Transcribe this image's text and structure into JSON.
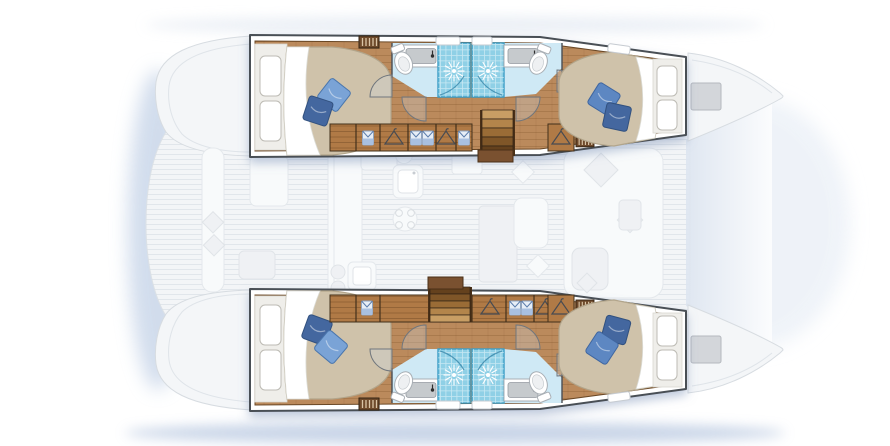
{
  "vessel": {
    "type": "catamaran yacht floor plan",
    "view": "top-down deck / cabin layout illustration",
    "hulls": 2,
    "orientation": "bows pointing right, sterns left",
    "cabins": 4,
    "bathrooms": 4
  },
  "inventory": {
    "double_beds": 4,
    "pillows_per_bed": 2,
    "showers": 4,
    "toilets": 4,
    "sinks": 4,
    "staircases": 2,
    "hanging_lockers": "wardrobes with hanger and folded-shirt symbols in each hull",
    "bow_deck_hatches": 2,
    "ghosted_areas": "aft cockpit with bench and table, central salon with galley sink, stove, dining table, chairs and forward lounge"
  },
  "colors": {
    "hull_outline": "#4a4f55",
    "wood": "#bb8a5c",
    "wood_dark": "#7c5330",
    "locker": "#b07a46",
    "bed": "#cfc2aa",
    "bed_edge": "#b2a58b",
    "pillow_light": "#7aa3d6",
    "pillow_mid": "#5d87c2",
    "pillow_dark": "#44679f",
    "bath_floor": "#cfe9f5",
    "shower": "#8fd0e6",
    "shower_edge": "#3c9ec6",
    "basin": "#c6cacd",
    "hatch": "#d3d6da",
    "shadow_blue": "#b7c7e0",
    "ghost_deck": "#f3f5f7"
  }
}
